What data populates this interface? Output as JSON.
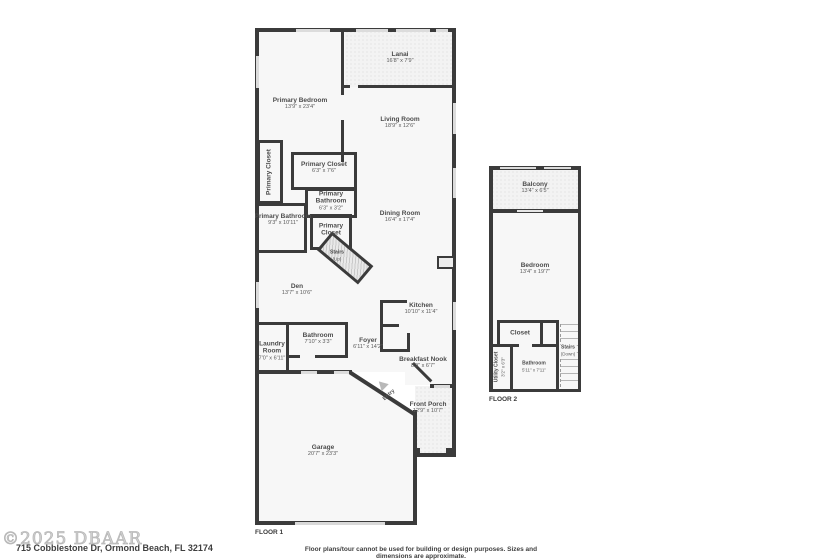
{
  "page": {
    "copyright": "©2025 DBAAR",
    "address": "715 Cobblestone Dr, Ormond Beach, FL 32174",
    "disclaimer": "Floor plans/tour cannot be used for building or design purposes. Sizes and dimensions are approximate."
  },
  "colors": {
    "wall": "#3b3b3b",
    "room_fill": "#f7f7f7",
    "hatch_fill": "#f3f3f3",
    "label_text": "#4c4c4c"
  },
  "floor1": {
    "label": "FLOOR 1",
    "rooms": {
      "primary_bedroom": {
        "name": "Primary Bedroom",
        "dims": "13'9\" x 23'4\""
      },
      "lanai": {
        "name": "Lanai",
        "dims": "16'8\" x 7'9\""
      },
      "living_room": {
        "name": "Living Room",
        "dims": "18'9\" x 12'6\""
      },
      "primary_closet_left": {
        "name": "Primary Closet",
        "dims": ""
      },
      "primary_closet_center": {
        "name": "Primary Closet",
        "dims": "6'3\" x 7'6\""
      },
      "primary_bathroom_small": {
        "name": "Primary Bathroom",
        "dims": "6'3\" x 3'2\""
      },
      "primary_bathroom": {
        "name": "Primary Bathroom",
        "dims": "9'3\" x 10'11\""
      },
      "primary_closet_small": {
        "name": "Primary Closet",
        "dims": ""
      },
      "dining_room": {
        "name": "Dining Room",
        "dims": "16'4\" x 17'4\""
      },
      "stairs_up": {
        "name": "Stairs",
        "dims": "(Up)"
      },
      "den": {
        "name": "Den",
        "dims": "13'7\" x 10'6\""
      },
      "bathroom": {
        "name": "Bathroom",
        "dims": "7'10\" x 3'3\""
      },
      "laundry_room": {
        "name": "Laundry Room",
        "dims": "7'0\" x 6'11\""
      },
      "kitchen": {
        "name": "Kitchen",
        "dims": "10'10\" x 11'4\""
      },
      "foyer": {
        "name": "Foyer",
        "dims": "6'11\" x 14'2\""
      },
      "breakfast_nook": {
        "name": "Breakfast Nook",
        "dims": "8'9\" x 6'7\""
      },
      "entry": {
        "name": "Entry",
        "dims": ""
      },
      "front_porch": {
        "name": "Front Porch",
        "dims": "12'9\" x 10'7\""
      },
      "garage": {
        "name": "Garage",
        "dims": "20'7\" x 23'3\""
      }
    }
  },
  "floor2": {
    "label": "FLOOR 2",
    "rooms": {
      "balcony": {
        "name": "Balcony",
        "dims": "13'4\" x 6'5\""
      },
      "bedroom": {
        "name": "Bedroom",
        "dims": "13'4\" x 19'7\""
      },
      "closet": {
        "name": "Closet",
        "dims": ""
      },
      "utility_closet": {
        "name": "Utility Closet",
        "dims": "3'2\" x 6'3\""
      },
      "bathroom": {
        "name": "Bathroom",
        "dims": "5'11\" x 7'11\""
      },
      "stairs_down": {
        "name": "Stairs",
        "dims": "(Down)"
      }
    }
  }
}
